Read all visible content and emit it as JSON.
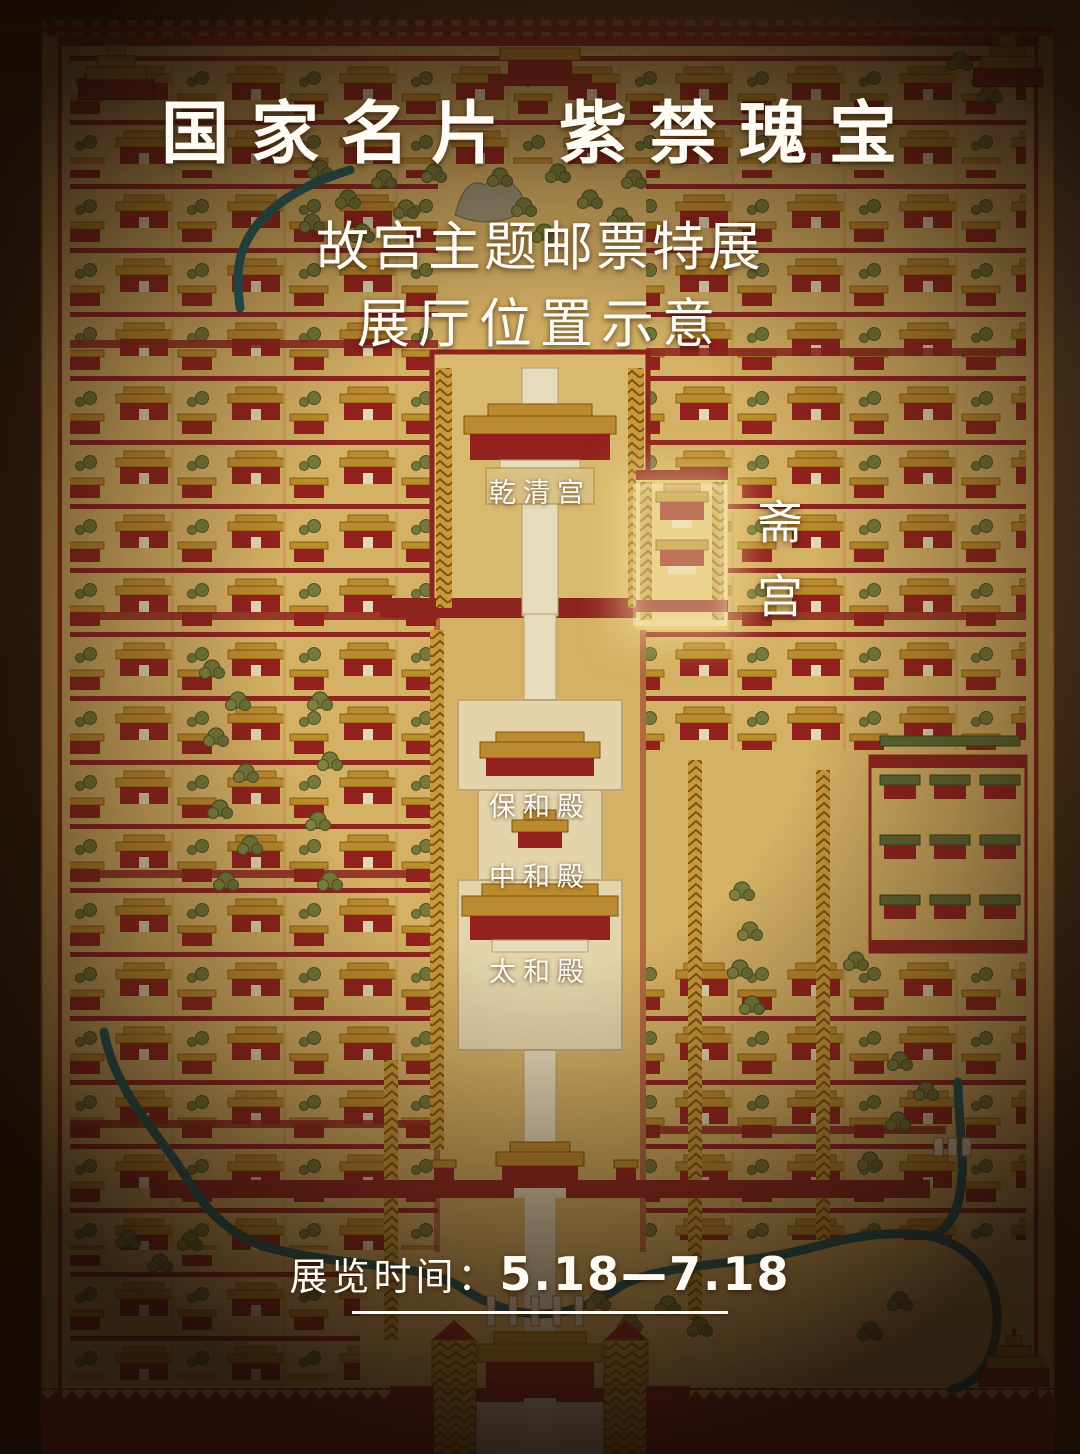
{
  "poster": {
    "title": {
      "part1": "国家名片",
      "part2": "紫禁瑰宝"
    },
    "subtitle_line1": "故宫主题邮票特展",
    "subtitle_line2": "展厅位置示意",
    "footer": {
      "label": "展览时间：",
      "dates": "5.18—7.18"
    }
  },
  "map": {
    "labels": {
      "qianqinggong": "乾清宫",
      "zhaigong": "斋宫",
      "baohedian": "保和殿",
      "zhonghedian": "中和殿",
      "taihedian": "太和殿"
    },
    "highlighted_hall": "斋宫",
    "colors": {
      "map_base": "#d5b165",
      "wall_red": "#8e2420",
      "building_red": "#93221e",
      "roof_gold": "#bd8b2f",
      "marble_cream": "#e7dbbd",
      "tree_green": "#75793b",
      "green_roof": "#5e6a34",
      "river_teal": "#1d5b60",
      "highlight_glow": "#fce9a8",
      "frame_brown": "#2a180c",
      "text_white": "#fdfbf4"
    }
  }
}
